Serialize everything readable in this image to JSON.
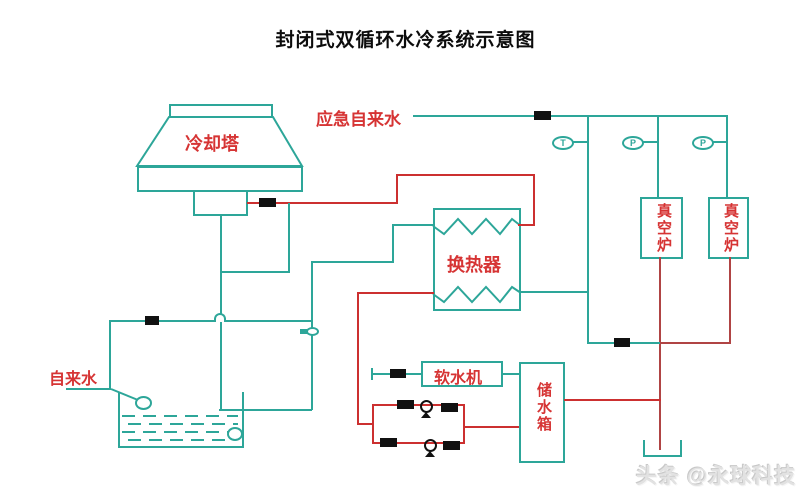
{
  "title": "封闭式双循环水冷系统示意图",
  "watermark": "头条 @永球科技",
  "colors": {
    "pipe_teal": "#2da699",
    "pipe_red": "#cc3030",
    "pipe_dark_red": "#b04444",
    "label_red": "#d63434",
    "valve_black": "#111111",
    "background": "#ffffff"
  },
  "labels": {
    "cooling_tower": "冷却塔",
    "emergency_water": "应急自来水",
    "heat_exchanger": "换热器",
    "water_softener": "软水机",
    "storage_tank": "储水箱",
    "tap_water": "自来水"
  },
  "vacuum_furnaces": [
    {
      "label": "真空炉"
    },
    {
      "label": "真空炉"
    }
  ],
  "instruments": [
    {
      "label": "T"
    },
    {
      "label": "P"
    },
    {
      "label": "P"
    }
  ]
}
